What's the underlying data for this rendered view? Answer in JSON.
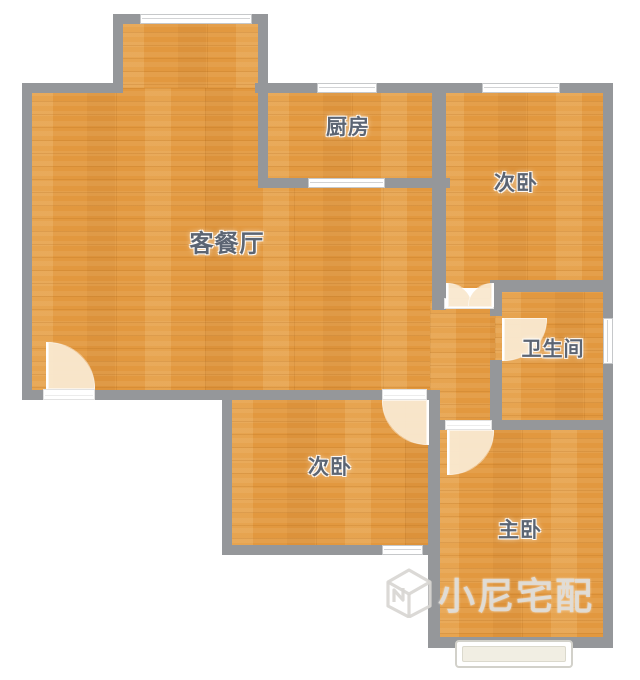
{
  "plan": {
    "title": "apartment-floor-plan",
    "rooms": [
      {
        "id": "living-dining",
        "label": "客餐厅"
      },
      {
        "id": "kitchen",
        "label": "厨房"
      },
      {
        "id": "bedroom-second-top",
        "label": "次卧"
      },
      {
        "id": "bathroom",
        "label": "卫生间"
      },
      {
        "id": "bedroom-second-bottom",
        "label": "次卧"
      },
      {
        "id": "master-bedroom",
        "label": "主卧"
      }
    ],
    "features": {
      "windows": 7,
      "door_swings": 5,
      "entry_door": "bottom-left of living room",
      "bay_window": "below master bedroom"
    },
    "watermark": {
      "logo": "cube-n-logo",
      "text": "小尼宅配"
    },
    "colors": {
      "floor": "#e2983f",
      "wall": "#95979a",
      "label": "#5c6573",
      "door_swing": "#f8e6c9",
      "background": "#ffffff"
    }
  }
}
